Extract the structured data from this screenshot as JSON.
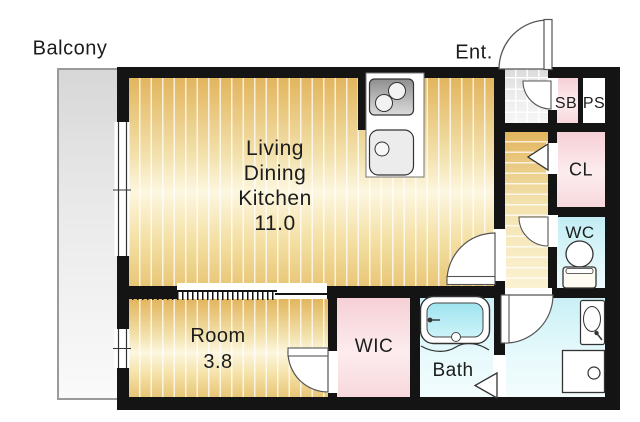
{
  "plan_title": "apartment-floor-plan",
  "rooms": {
    "balcony": {
      "label": "Balcony"
    },
    "ldk": {
      "line1": "Living",
      "line2": "Dining",
      "line3": "Kitchen",
      "area": "11.0"
    },
    "room": {
      "label": "Room",
      "area": "3.8"
    },
    "wic": {
      "label": "WIC"
    },
    "bath": {
      "label": "Bath"
    },
    "entrance": {
      "label": "Ent."
    },
    "shoe_box": {
      "label": "SB"
    },
    "pipe_space": {
      "label": "PS"
    },
    "closet": {
      "label": "CL"
    },
    "toilet": {
      "label": "WC"
    }
  },
  "colors": {
    "wall": "#141414",
    "wood_floor": "#eac878",
    "closet_pink": "#f6d0d6",
    "wet_area_cyan": "#c9f0f6",
    "toilet_cyan": "#c2edf4",
    "entrance_tile": "#e3e3e3",
    "balcony_gray": "#dddddd",
    "bath_water": "#a9e7f2",
    "background": "#ffffff"
  }
}
